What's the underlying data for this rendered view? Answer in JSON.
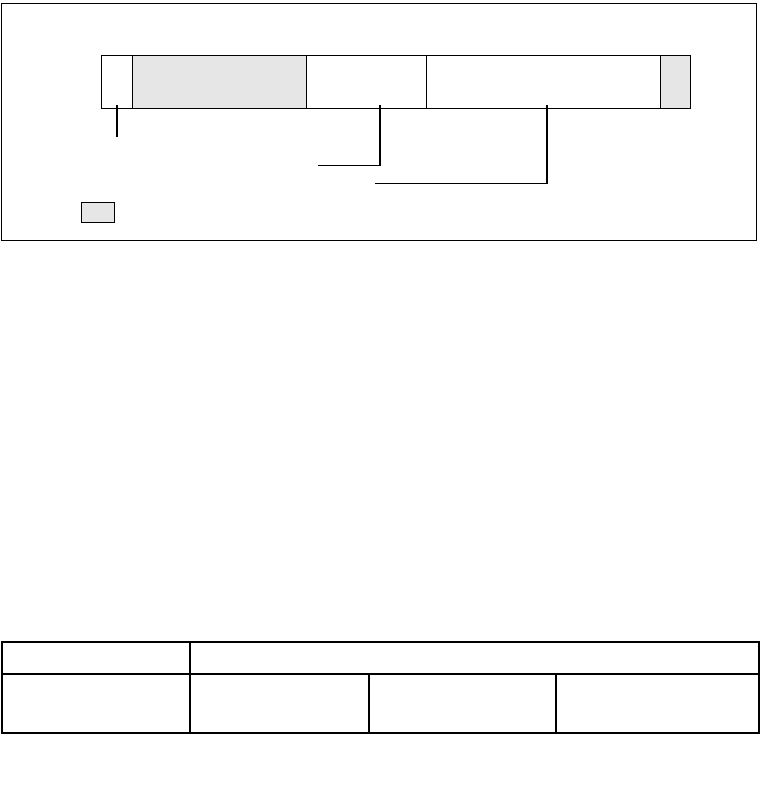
{
  "colors": {
    "background": "#ffffff",
    "line": "#000000",
    "shaded_fill": "#e6e6e6"
  },
  "figure": {
    "bar_segments": [
      {
        "name": "segment-1",
        "shaded": false,
        "label": ""
      },
      {
        "name": "segment-2",
        "shaded": true,
        "label": ""
      },
      {
        "name": "segment-3",
        "shaded": false,
        "label": ""
      },
      {
        "name": "segment-4",
        "shaded": true,
        "label": ""
      },
      {
        "name": "segment-5",
        "shaded": true,
        "label": ""
      }
    ],
    "callouts": [
      {
        "name": "callout-1",
        "type": "vertical-line",
        "from_segment": "segment-1",
        "label": ""
      },
      {
        "name": "callout-2",
        "type": "elbow-left",
        "from_segment": "segment-3",
        "label": ""
      },
      {
        "name": "callout-3",
        "type": "elbow-left",
        "from_segment": "segment-4",
        "label": ""
      }
    ],
    "legend_swatch": {
      "shaded": true,
      "label": ""
    }
  },
  "table": {
    "row1": [
      "",
      ""
    ],
    "row2": [
      "",
      "",
      "",
      ""
    ]
  }
}
